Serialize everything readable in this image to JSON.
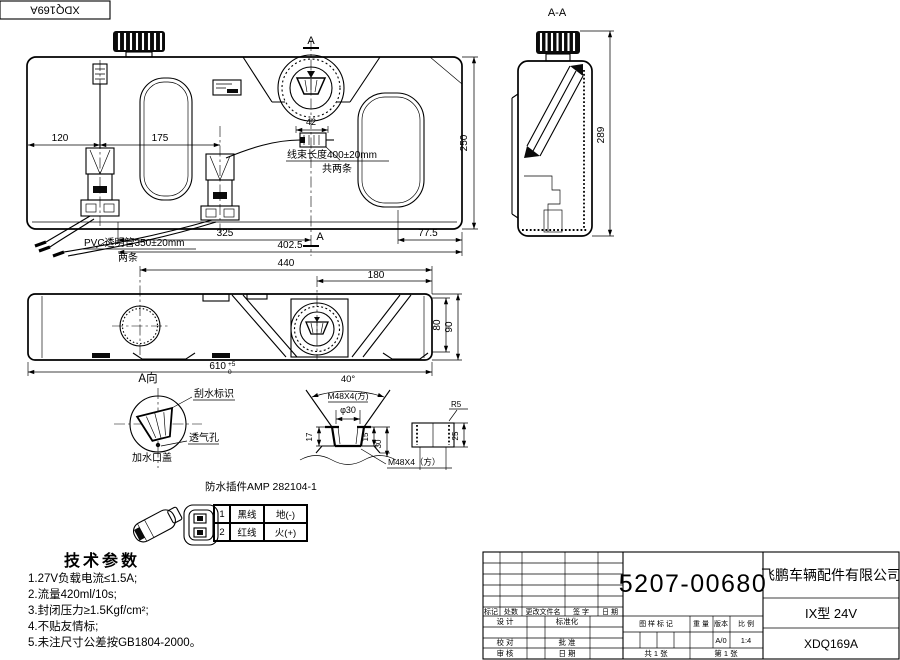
{
  "top_code": "XDQ169A",
  "drawing": {
    "front": {
      "d120": "120",
      "d175": "175",
      "d42": "42",
      "d250": "250",
      "d325": "325",
      "d77_5": "77.5",
      "d402_5": "402.5",
      "sec_a_top": "A",
      "sec_a_bottom": "A",
      "harness": "线束长度400±20mm",
      "harness_qty": "共两条",
      "pvc": "PVC透明管350±20mm",
      "pvc_qty": "两条"
    },
    "section": {
      "label": "A-A",
      "d289": "289"
    },
    "plan": {
      "d440": "440",
      "d180": "180",
      "d80": "80",
      "d90": "90",
      "d610": "610",
      "tol_up": "+5",
      "tol_dn": "0"
    },
    "cap_detail": {
      "title": "A向",
      "wiper_mark": "刮水标识",
      "vent": "透气孔",
      "filler_cap": "加水口盖"
    },
    "thread_detail": {
      "angle": "40°",
      "thread": "M48X4(方)",
      "dia": "φ30",
      "d17": "17",
      "d15": "15",
      "d30": "30",
      "thread2": "M48X4（方）",
      "r5": "R5",
      "d25": "25"
    },
    "connector": {
      "title": "防水插件AMP 282104-1",
      "rows": [
        [
          "1",
          "黑线",
          "地(-)"
        ],
        [
          "2",
          "红线",
          "火(+)"
        ]
      ]
    },
    "tech": {
      "title": "技术参数",
      "items": [
        "1.27V负载电流≤1.5A;",
        "2.流量420ml/10s;",
        "3.封闭压力≥1.5Kgf/cm²;",
        "4.不贴友情标;",
        "5.未注尺寸公差按GB1804-2000。"
      ]
    }
  },
  "title_block": {
    "part_number": "5207-00680",
    "company": "飞鹏车辆配件有限公司",
    "model": "IX型 24V",
    "code": "XDQ169A",
    "rev_headers": [
      "标记",
      "处数",
      "更改文件名",
      "签 字",
      "日 期"
    ],
    "roles": {
      "design": "设 计",
      "standard": "标准化",
      "check": "校 对",
      "approve": "批 准",
      "audit": "审 核",
      "date": "日 期"
    },
    "stamp": {
      "mark": "图 样 标 记",
      "weight": "重 量",
      "version": "版本",
      "scale": "比 例",
      "version_val": "A/0",
      "scale_val": "1:4",
      "sheets": "共 1 张",
      "sheet_no": "第 1 张"
    }
  }
}
